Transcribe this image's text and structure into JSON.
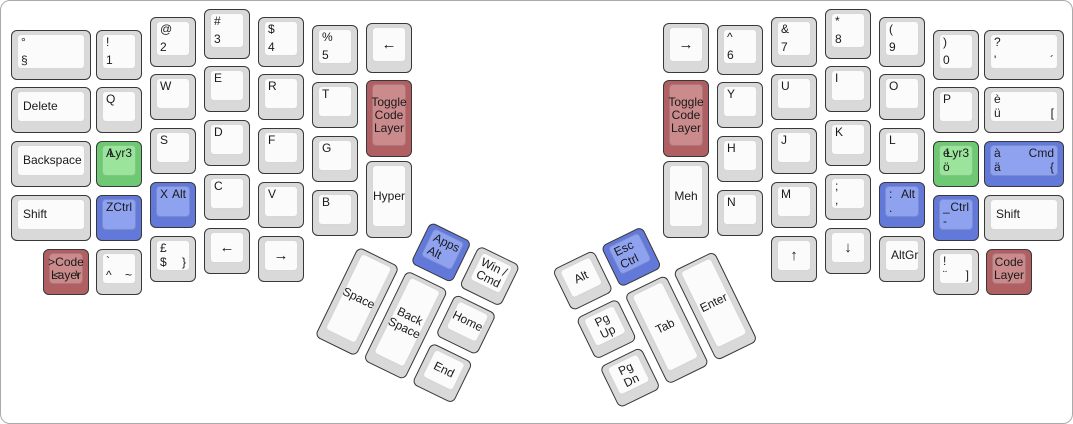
{
  "keyboard": {
    "description": "Split ergonomic keyboard layout (ErgoDox style), Swiss-German legends with layer keys",
    "colors": {
      "gray": {
        "base": "#d9d9d9",
        "surface": "#fbfbfb"
      },
      "green": {
        "base": "#6fc873",
        "surface": "#9ae59b"
      },
      "blue": {
        "base": "#6379da",
        "surface": "#8fa2f0"
      },
      "red": {
        "base": "#b06063",
        "surface": "#cb8a8c"
      },
      "outline": "#383838",
      "text": "#1a1a1a"
    },
    "groups": [
      {
        "name": "left-main",
        "x": 0,
        "y": 0,
        "rotation": 0,
        "keys": [
          {
            "id": "sect",
            "x": 10,
            "y": 29,
            "w": 80,
            "h": 50,
            "tl": "°",
            "bl": "§"
          },
          {
            "id": "delete",
            "x": 10,
            "y": 86,
            "w": 80,
            "c": "Delete",
            "align": "midleft"
          },
          {
            "id": "backspace",
            "x": 10,
            "y": 140,
            "w": 80,
            "c": "Backspace",
            "align": "midleft"
          },
          {
            "id": "shift-left",
            "x": 10,
            "y": 194,
            "w": 80,
            "c": "Shift",
            "align": "midleft"
          },
          {
            "id": "code-layer-left",
            "x": 42,
            "y": 248,
            "color": "red",
            "c": ">Code\nLayer",
            "bl": "<",
            "br": "\\"
          },
          {
            "id": "num1",
            "x": 95,
            "y": 29,
            "h": 50,
            "tl": "!",
            "bl": "1"
          },
          {
            "id": "q",
            "x": 95,
            "y": 86,
            "tl": "Q"
          },
          {
            "id": "a-lyr3",
            "x": 95,
            "y": 140,
            "color": "green",
            "tl": "A",
            "tr": "Lyr3"
          },
          {
            "id": "z-ctrl",
            "x": 95,
            "y": 194,
            "color": "blue",
            "tl": "Z",
            "tr": "Ctrl"
          },
          {
            "id": "circumflex",
            "x": 95,
            "y": 248,
            "tl": "`",
            "bl": "^",
            "br": "~"
          },
          {
            "id": "num2",
            "x": 149,
            "y": 16,
            "h": 50,
            "tl": "@",
            "bl": "2"
          },
          {
            "id": "w",
            "x": 149,
            "y": 73,
            "tl": "W"
          },
          {
            "id": "s",
            "x": 149,
            "y": 127,
            "tl": "S"
          },
          {
            "id": "x-alt",
            "x": 149,
            "y": 181,
            "color": "blue",
            "tl": "X",
            "tr": "Alt"
          },
          {
            "id": "dollar",
            "x": 149,
            "y": 235,
            "tl": "£",
            "bl": "$",
            "br": "}"
          },
          {
            "id": "num3",
            "x": 203,
            "y": 8,
            "h": 50,
            "tl": "#",
            "bl": "3"
          },
          {
            "id": "e",
            "x": 203,
            "y": 65,
            "tl": "E"
          },
          {
            "id": "d",
            "x": 203,
            "y": 119,
            "tl": "D"
          },
          {
            "id": "c",
            "x": 203,
            "y": 173,
            "tl": "C"
          },
          {
            "id": "left-arrow-bottom",
            "x": 203,
            "y": 227,
            "c": "←"
          },
          {
            "id": "num4",
            "x": 257,
            "y": 16,
            "h": 50,
            "tl": "$",
            "bl": "4"
          },
          {
            "id": "r",
            "x": 257,
            "y": 73,
            "tl": "R"
          },
          {
            "id": "f",
            "x": 257,
            "y": 127,
            "tl": "F"
          },
          {
            "id": "v",
            "x": 257,
            "y": 181,
            "tl": "V"
          },
          {
            "id": "right-arrow-bottom",
            "x": 257,
            "y": 235,
            "c": "→"
          },
          {
            "id": "num5",
            "x": 311,
            "y": 24,
            "h": 50,
            "tl": "%",
            "bl": "5"
          },
          {
            "id": "t",
            "x": 311,
            "y": 81,
            "tl": "T"
          },
          {
            "id": "g",
            "x": 311,
            "y": 135,
            "tl": "G"
          },
          {
            "id": "b",
            "x": 311,
            "y": 189,
            "tl": "B"
          },
          {
            "id": "left-arrow-top",
            "x": 365,
            "y": 22,
            "h": 50,
            "c": "←"
          },
          {
            "id": "toggle-code-layer-left",
            "x": 365,
            "y": 79,
            "h": 77,
            "color": "red",
            "c": "Toggle\nCode\nLayer"
          },
          {
            "id": "hyper",
            "x": 365,
            "y": 160,
            "h": 77,
            "c": "Hyper"
          }
        ]
      },
      {
        "name": "right-main",
        "x": 0,
        "y": 0,
        "rotation": 0,
        "keys": [
          {
            "id": "right-arrow-top",
            "x": 662,
            "y": 22,
            "h": 50,
            "c": "→"
          },
          {
            "id": "toggle-code-layer-right",
            "x": 662,
            "y": 79,
            "h": 77,
            "color": "red",
            "c": "Toggle\nCode\nLayer"
          },
          {
            "id": "meh",
            "x": 662,
            "y": 160,
            "h": 77,
            "c": "Meh"
          },
          {
            "id": "num6",
            "x": 716,
            "y": 24,
            "h": 50,
            "tl": "^",
            "bl": "6"
          },
          {
            "id": "y",
            "x": 716,
            "y": 81,
            "tl": "Y"
          },
          {
            "id": "h",
            "x": 716,
            "y": 135,
            "tl": "H"
          },
          {
            "id": "n",
            "x": 716,
            "y": 189,
            "tl": "N"
          },
          {
            "id": "num7",
            "x": 770,
            "y": 16,
            "h": 50,
            "tl": "&",
            "bl": "7"
          },
          {
            "id": "u",
            "x": 770,
            "y": 73,
            "tl": "U"
          },
          {
            "id": "j",
            "x": 770,
            "y": 127,
            "tl": "J"
          },
          {
            "id": "m",
            "x": 770,
            "y": 181,
            "tl": "M"
          },
          {
            "id": "up-arrow",
            "x": 770,
            "y": 235,
            "c": "↑"
          },
          {
            "id": "num8",
            "x": 824,
            "y": 8,
            "h": 50,
            "tl": "*",
            "bl": "8"
          },
          {
            "id": "i",
            "x": 824,
            "y": 65,
            "tl": "I"
          },
          {
            "id": "k",
            "x": 824,
            "y": 119,
            "tl": "K"
          },
          {
            "id": "semicolon",
            "x": 824,
            "y": 173,
            "tl": ";",
            "bl": ","
          },
          {
            "id": "down-arrow",
            "x": 824,
            "y": 227,
            "c": "↓"
          },
          {
            "id": "num9",
            "x": 878,
            "y": 16,
            "h": 50,
            "tl": "(",
            "bl": "9"
          },
          {
            "id": "o",
            "x": 878,
            "y": 73,
            "tl": "O"
          },
          {
            "id": "l",
            "x": 878,
            "y": 127,
            "tl": "L"
          },
          {
            "id": "colon-alt",
            "x": 878,
            "y": 181,
            "color": "blue",
            "tl": ":",
            "tr": "Alt",
            "bl": "."
          },
          {
            "id": "altgr",
            "x": 878,
            "y": 235,
            "c": "AltGr",
            "align": "midleft"
          },
          {
            "id": "num0",
            "x": 932,
            "y": 29,
            "h": 50,
            "tl": ")",
            "bl": "0"
          },
          {
            "id": "p",
            "x": 932,
            "y": 86,
            "tl": "P"
          },
          {
            "id": "e-acute-lyr3",
            "x": 932,
            "y": 140,
            "color": "green",
            "tl": "é",
            "tr": "Lyr3",
            "bl": "ö"
          },
          {
            "id": "underscore-ctrl",
            "x": 932,
            "y": 194,
            "color": "blue",
            "tl": "_",
            "tr": "Ctrl",
            "bl": "-"
          },
          {
            "id": "diaeresis",
            "x": 932,
            "y": 248,
            "tl": "!",
            "bl": "¨",
            "br": "]"
          },
          {
            "id": "apostrophe",
            "x": 983,
            "y": 29,
            "w": 80,
            "h": 50,
            "tl": "?",
            "bl": "'",
            "br": "´"
          },
          {
            "id": "e-grave",
            "x": 983,
            "y": 86,
            "w": 80,
            "tl": "è",
            "bl": "ü",
            "br": "["
          },
          {
            "id": "a-grave-cmd",
            "x": 983,
            "y": 140,
            "w": 80,
            "color": "blue",
            "tl": "à",
            "tr": "Cmd",
            "bl": "ä",
            "br": "{"
          },
          {
            "id": "shift-right",
            "x": 983,
            "y": 194,
            "w": 80,
            "c": "Shift",
            "align": "midleft"
          },
          {
            "id": "code-layer-right",
            "x": 985,
            "y": 248,
            "color": "red",
            "c": "Code\nLayer"
          }
        ]
      },
      {
        "name": "left-thumb",
        "x": 381,
        "y": 197,
        "rotation": 26,
        "keys": [
          {
            "id": "apps-alt",
            "x": 54,
            "y": 0,
            "color": "blue",
            "tl": "Apps",
            "bl": "Alt"
          },
          {
            "id": "win-cmd",
            "x": 108,
            "y": 0,
            "c": "Win /\nCmd"
          },
          {
            "id": "space",
            "x": 0,
            "y": 54,
            "h": 100,
            "c": "Space"
          },
          {
            "id": "backspace-thumb",
            "x": 54,
            "y": 54,
            "h": 100,
            "c": "Back\nSpace"
          },
          {
            "id": "home",
            "x": 108,
            "y": 54,
            "c": "Home"
          },
          {
            "id": "end",
            "x": 108,
            "y": 108,
            "c": "End"
          }
        ]
      },
      {
        "name": "right-thumb",
        "x": 551,
        "y": 269,
        "rotation": -26,
        "keys": [
          {
            "id": "alt-thumb",
            "x": 0,
            "y": 0,
            "c": "Alt"
          },
          {
            "id": "esc-ctrl",
            "x": 54,
            "y": 0,
            "color": "blue",
            "tl": "Esc",
            "bl": "Ctrl"
          },
          {
            "id": "pgup",
            "x": 0,
            "y": 54,
            "c": "Pg Up"
          },
          {
            "id": "tab",
            "x": 54,
            "y": 54,
            "h": 100,
            "c": "Tab"
          },
          {
            "id": "enter",
            "x": 108,
            "y": 54,
            "h": 100,
            "c": "Enter"
          },
          {
            "id": "pgdn",
            "x": 0,
            "y": 108,
            "c": "Pg Dn"
          }
        ]
      }
    ]
  }
}
